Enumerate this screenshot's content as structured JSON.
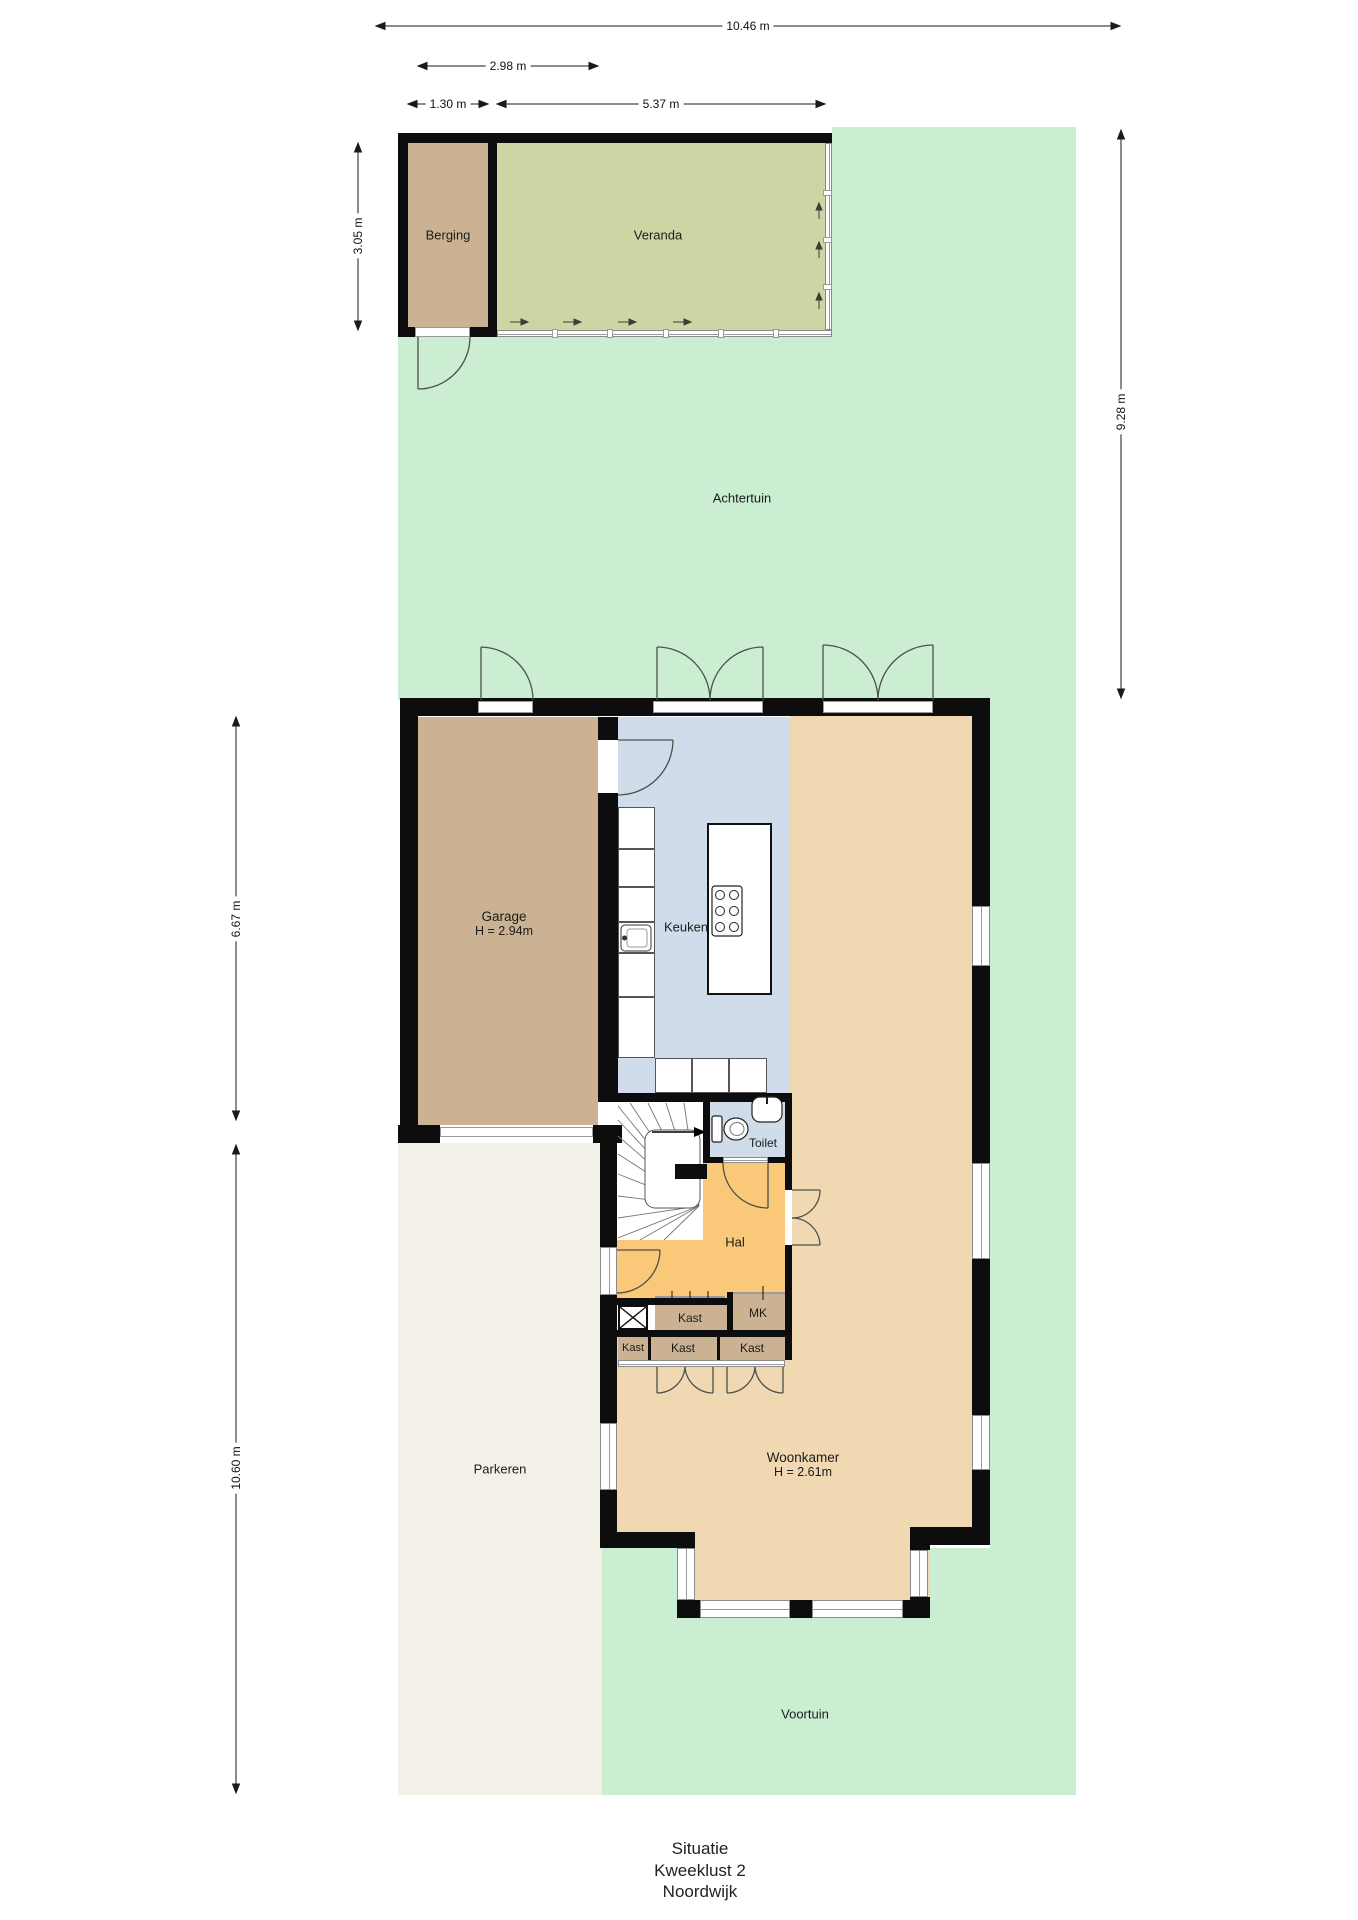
{
  "title": {
    "lines": [
      "Situatie",
      "Kweeklust 2",
      "Noordwijk"
    ]
  },
  "dimensions": {
    "overall_width": "10.46 m",
    "garage_width": "2.98 m",
    "berging_width": "1.30 m",
    "veranda_width": "5.37 m",
    "berging_depth": "3.05 m",
    "achtertuin_depth": "9.28 m",
    "garage_depth": "6.67 m",
    "front_depth": "10.60 m"
  },
  "rooms": {
    "berging": "Berging",
    "veranda": "Veranda",
    "achtertuin": "Achtertuin",
    "garage": "Garage",
    "garage_height": "H = 2.94m",
    "keuken": "Keuken",
    "toilet": "Toilet",
    "hal": "Hal",
    "kast": "Kast",
    "mk": "MK",
    "woonkamer": "Woonkamer",
    "woonkamer_height": "H = 2.61m",
    "parkeren": "Parkeren",
    "voortuin": "Voortuin"
  },
  "colors": {
    "grass": "#cbeed3",
    "veranda": "#ccd6a4",
    "storage": "#cbb293",
    "kitchen": "#d0dcea",
    "living": "#f0d9b2",
    "hall": "#f9c878",
    "parking": "#f3f1e7",
    "wall": "#0d0d0d"
  }
}
